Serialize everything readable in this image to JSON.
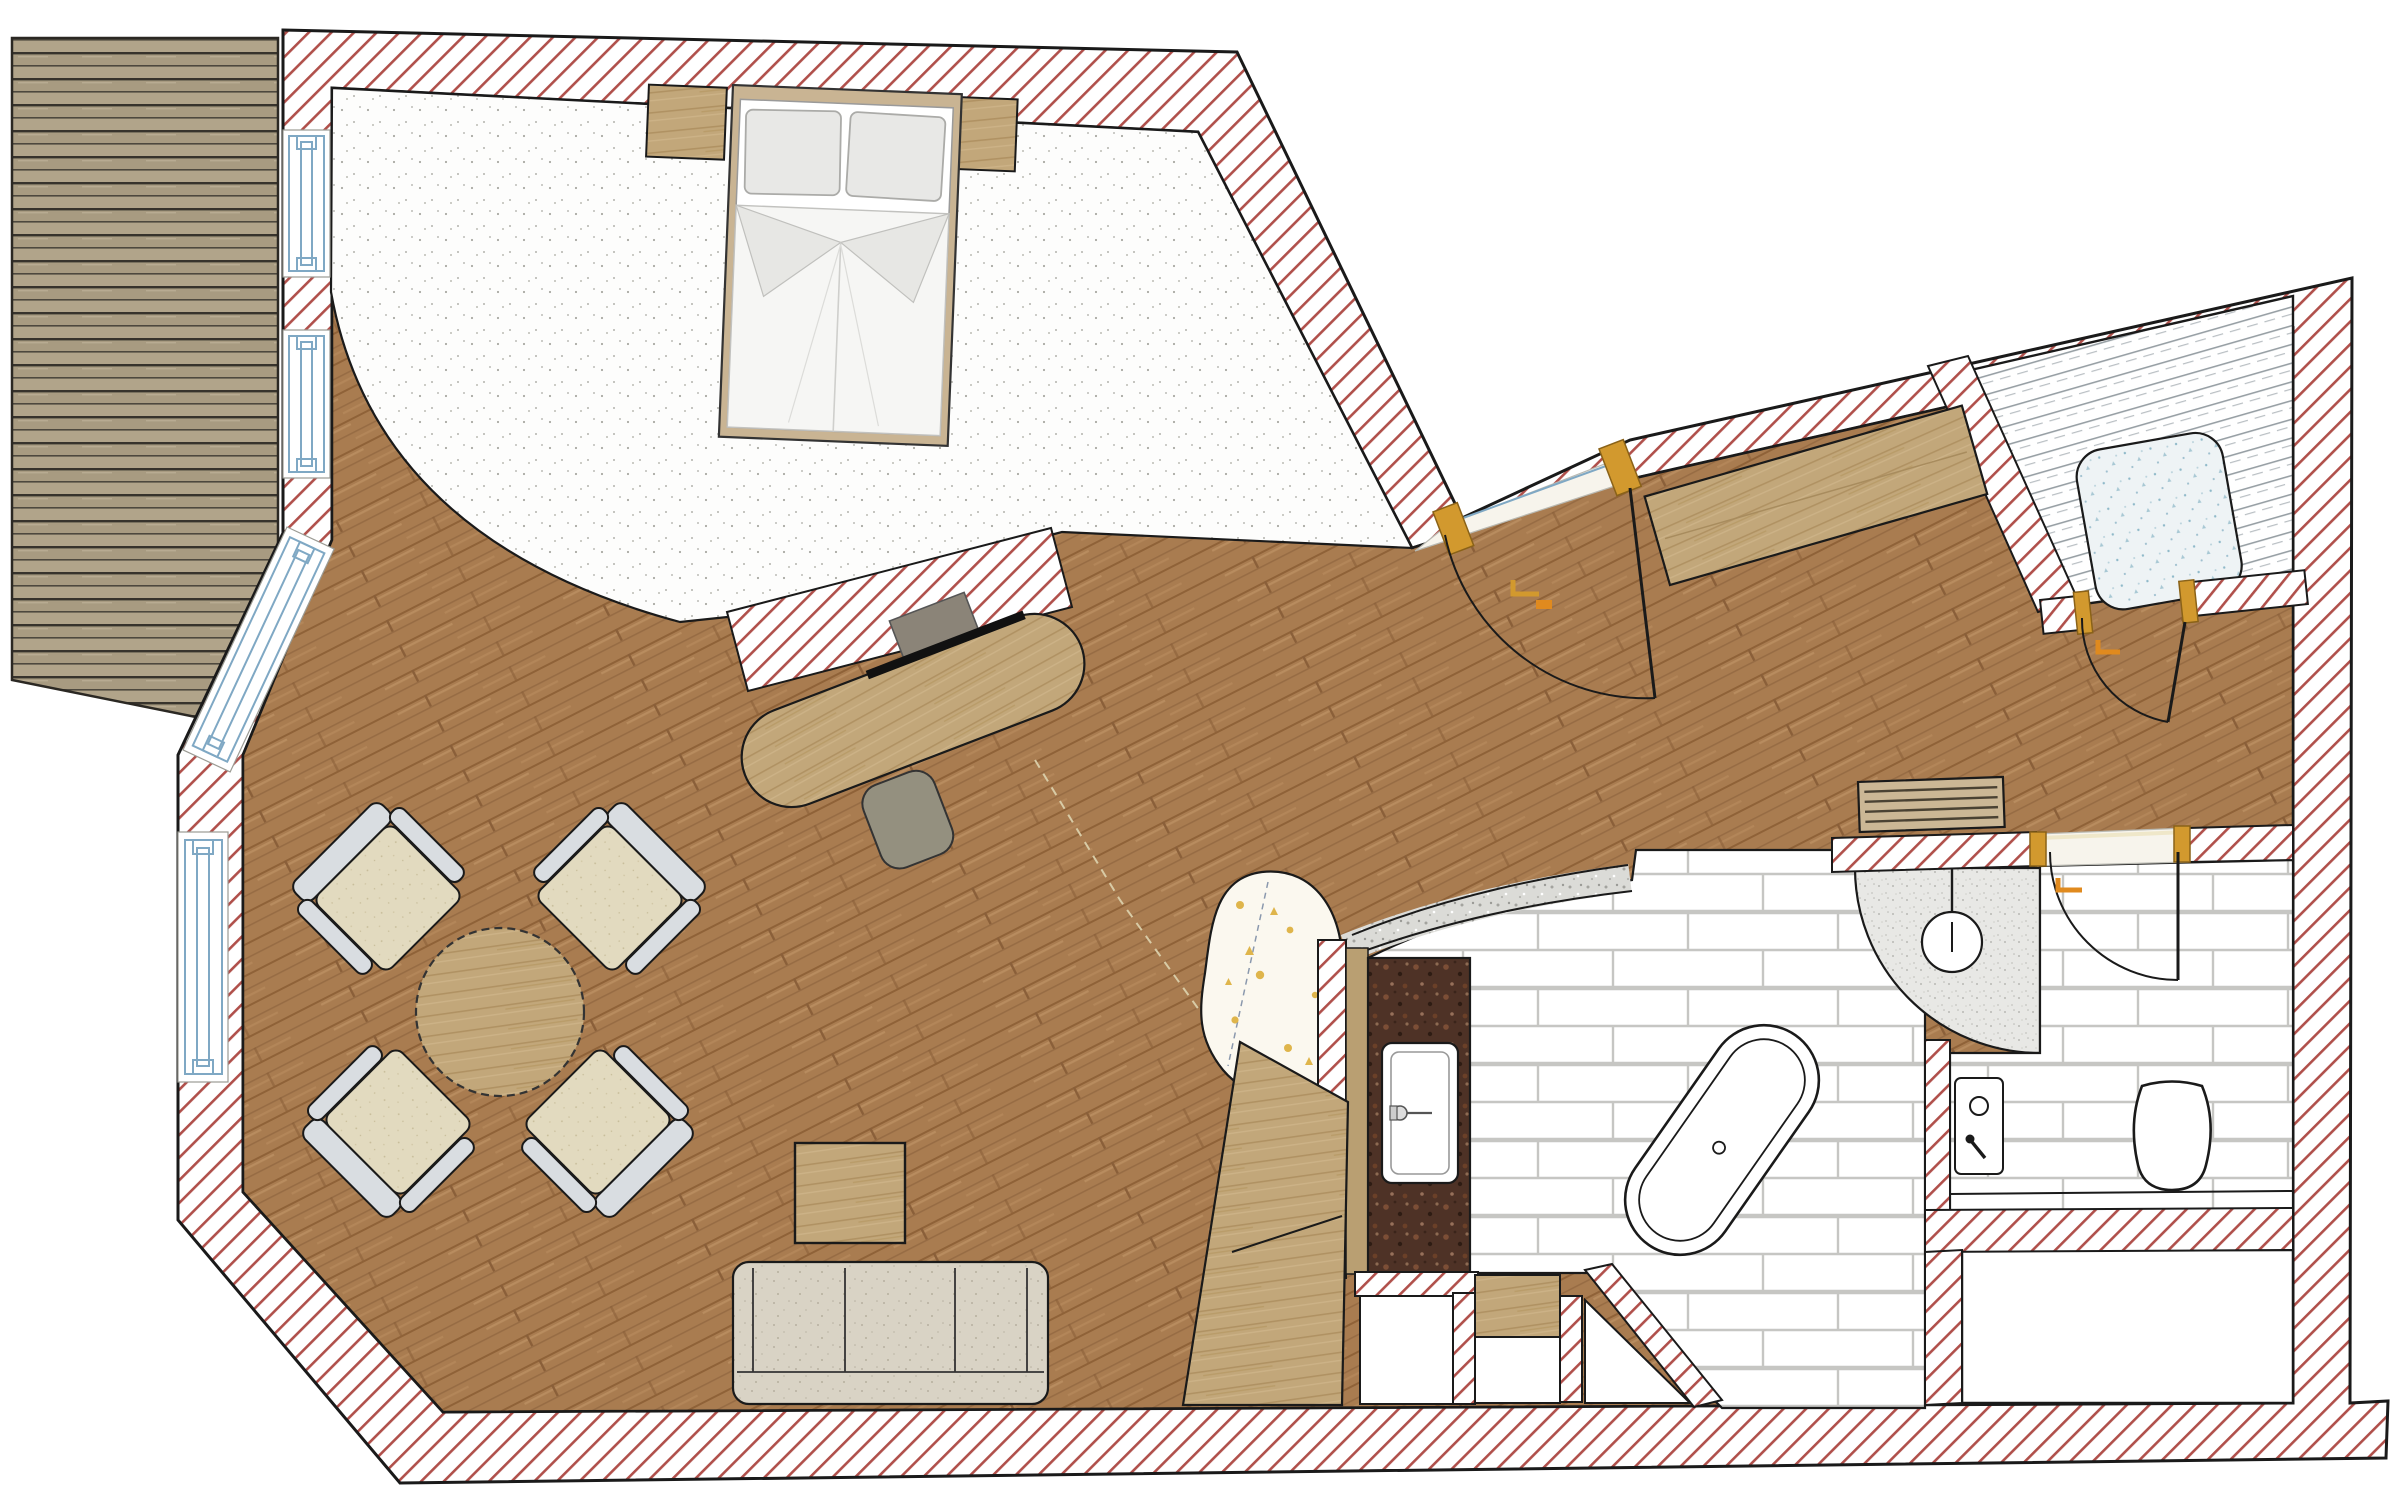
{
  "floorplan": {
    "type": "apartment-floor-plan",
    "colors": {
      "wall_hatch_line": "#b0504b",
      "wall_outline": "#1a1a1a",
      "wood_floor": "#a97c50",
      "deck_plank": "#b1a48a",
      "carpet": "#fdfdfc",
      "tile_grout": "#c6c6c3",
      "furniture_wood": "#c2a77a",
      "granite_counter": "#4e3226",
      "window_frame": "#7fa8c4",
      "door_frame_gold": "#d2992e",
      "rug_fleck_gold": "#dfb54b",
      "glass_line": "#98a0a5"
    },
    "rooms": [
      {
        "name": "bedroom",
        "floor": "carpet"
      },
      {
        "name": "living-dining-area",
        "floor": "wood"
      },
      {
        "name": "entrance-corridor",
        "floor": "wood"
      },
      {
        "name": "bathroom",
        "floor": "tile"
      },
      {
        "name": "wc",
        "floor": "tile"
      },
      {
        "name": "steam-shower-room",
        "floor": "glass-enclosed"
      },
      {
        "name": "balcony-deck",
        "floor": "wood-planks"
      },
      {
        "name": "storage-room",
        "floor": "none"
      }
    ],
    "furniture": [
      "double-bed",
      "nightstand-left",
      "nightstand-right",
      "desk-with-tv",
      "desk-chair",
      "round-dining-table",
      "armchair-nw",
      "armchair-ne",
      "armchair-sw",
      "armchair-se",
      "sofa",
      "coffee-table",
      "angled-wardrobe",
      "corridor-closet",
      "radiator",
      "bathtub",
      "vanity-sink",
      "corner-shower",
      "toilet",
      "cistern-panel",
      "shower-tray",
      "organic-rug"
    ],
    "doors": [
      "entrance-door",
      "wc-door",
      "steam-room-door"
    ],
    "windows": [
      "bedroom-window-upper",
      "bedroom-window-lower",
      "balcony-french-window",
      "living-room-window"
    ]
  }
}
